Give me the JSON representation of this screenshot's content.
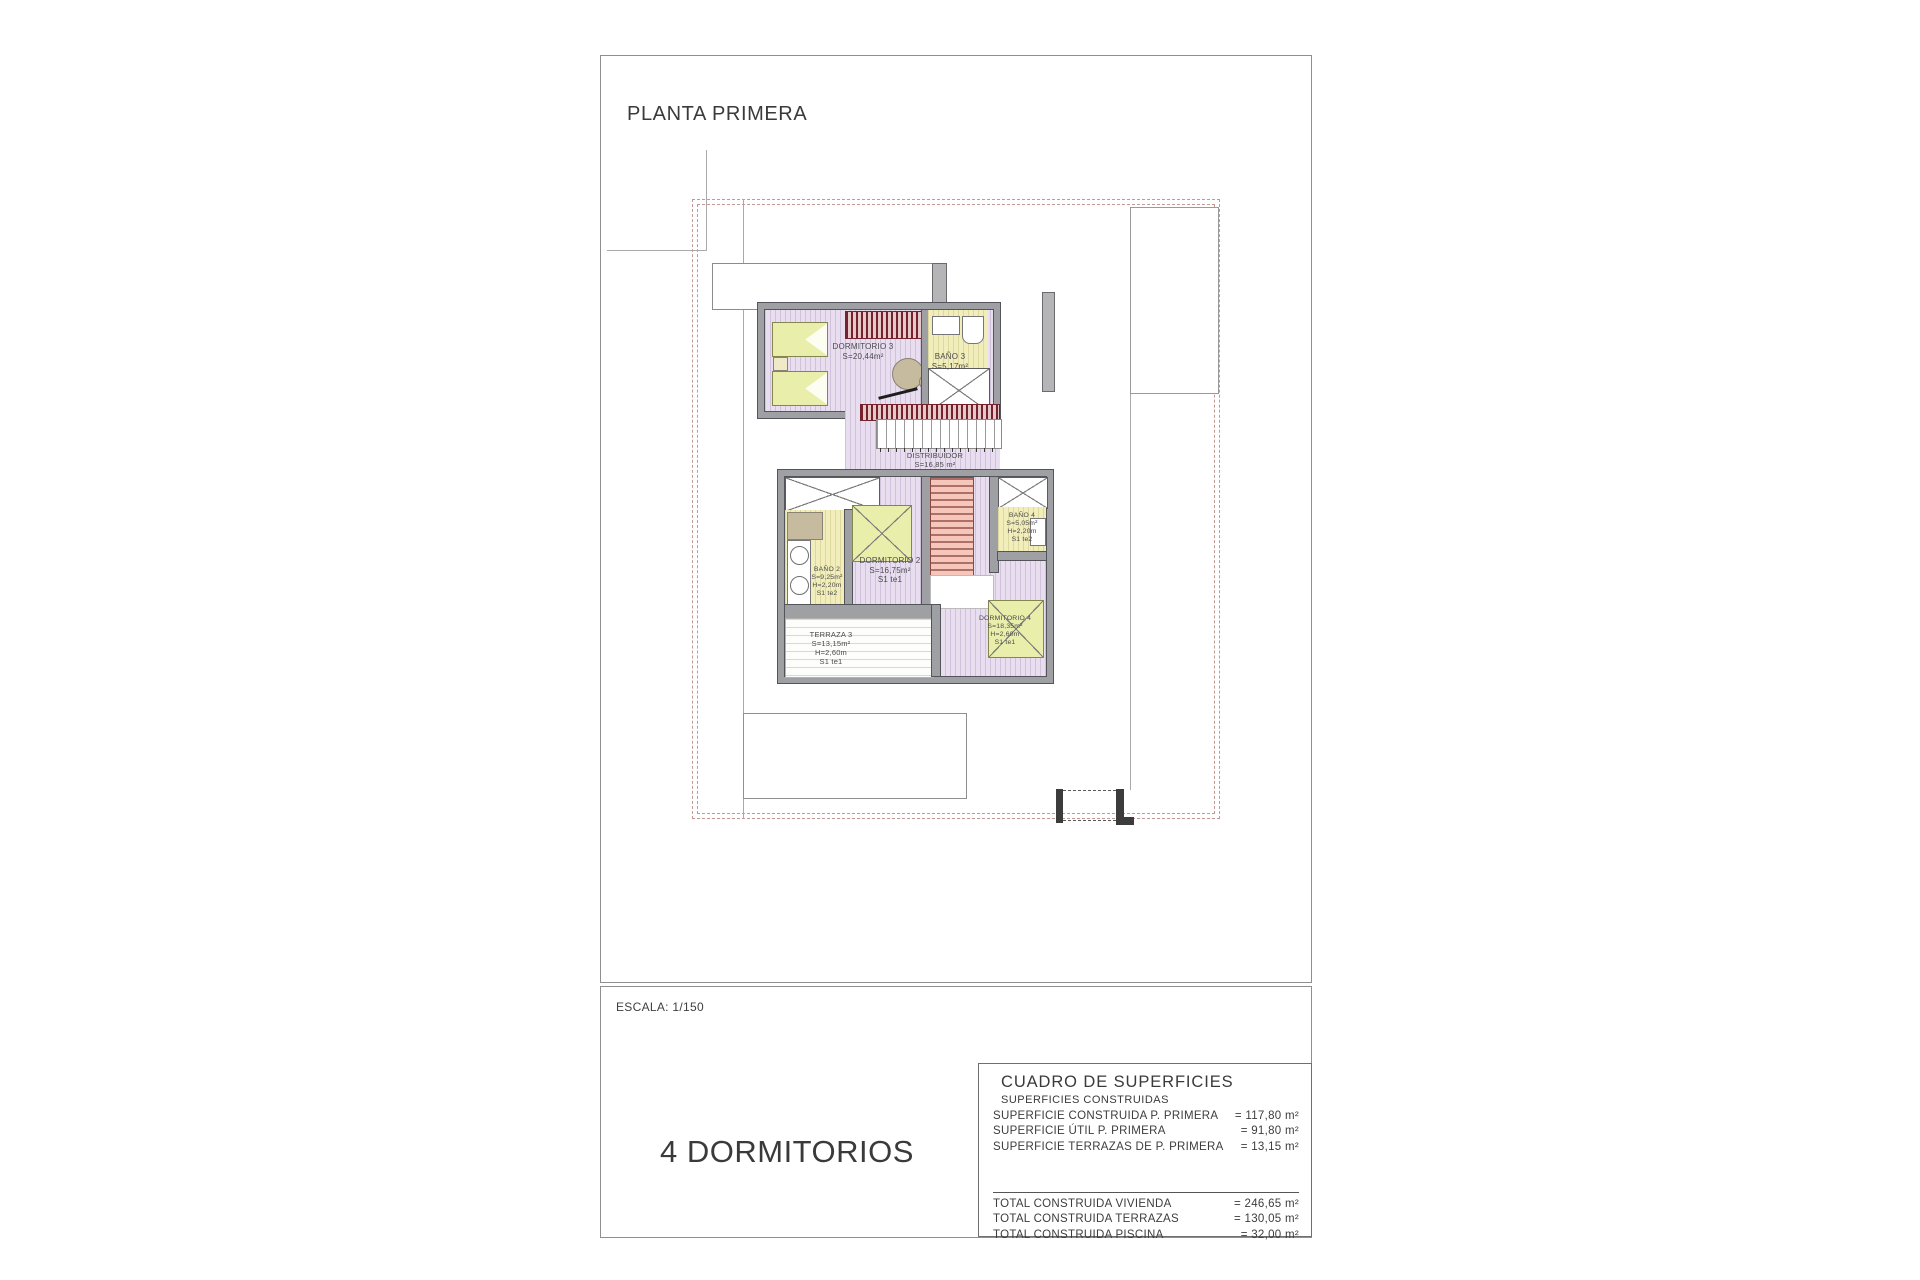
{
  "header": {
    "title": "PLANTA PRIMERA"
  },
  "footer": {
    "scale": "ESCALA: 1/150",
    "variant": "4 DORMITORIOS"
  },
  "rooms": {
    "dormitorio3": {
      "name": "DORMITORIO 3",
      "area": "S=20,44m²"
    },
    "bano3": {
      "name": "BAÑO 3",
      "area": "S=5,17m²"
    },
    "distribuidor": {
      "name": "DISTRIBUIDOR",
      "area": "S=16,85 m²"
    },
    "dormitorio2": {
      "name": "DORMITORIO 2",
      "area": "S=16,75m²",
      "note": "S1 te1"
    },
    "bano2": {
      "name": "BAÑO 2",
      "area": "S=9,25m²",
      "height": "H=2,20m",
      "note": "S1 te2"
    },
    "bano4": {
      "name": "BAÑO 4",
      "area": "S=5,05m²",
      "height": "H=2,20m",
      "note": "S1 te2"
    },
    "dormitorio4": {
      "name": "DORMITORIO 4",
      "area": "S=18,35m²",
      "height": "H=2,60m",
      "note": "S1 te1"
    },
    "terraza3": {
      "name": "TERRAZA 3",
      "area": "S=13,15m²",
      "height": "H=2,60m",
      "note": "S1 te1"
    }
  },
  "surface_table": {
    "title": "CUADRO DE SUPERFICIES",
    "subtitle": "SUPERFICIES CONSTRUIDAS",
    "rows": [
      {
        "label": "SUPERFICIE CONSTRUIDA P. PRIMERA",
        "value": "= 117,80 m²"
      },
      {
        "label": "SUPERFICIE ÚTIL P. PRIMERA",
        "value": "= 91,80 m²"
      },
      {
        "label": "SUPERFICIE TERRAZAS DE P. PRIMERA",
        "value": "= 13,15 m²"
      }
    ],
    "totals": [
      {
        "label": "TOTAL CONSTRUIDA VIVIENDA",
        "value": "= 246,65 m²"
      },
      {
        "label": "TOTAL CONSTRUIDA TERRAZAS",
        "value": "= 130,05 m²"
      },
      {
        "label": "TOTAL CONSTRUIDA PISCINA",
        "value": "= 32,00 m²"
      }
    ]
  },
  "palette": {
    "floor_lavender": "#e8def0",
    "bath_yellow": "#f2eebb",
    "bed_green": "#e9efab",
    "stair_salmon": "#f7c6bb",
    "wardrobe_red": "#73222e",
    "boundary_dash": "#c29a91",
    "wall_gray": "#9fa0a3"
  }
}
